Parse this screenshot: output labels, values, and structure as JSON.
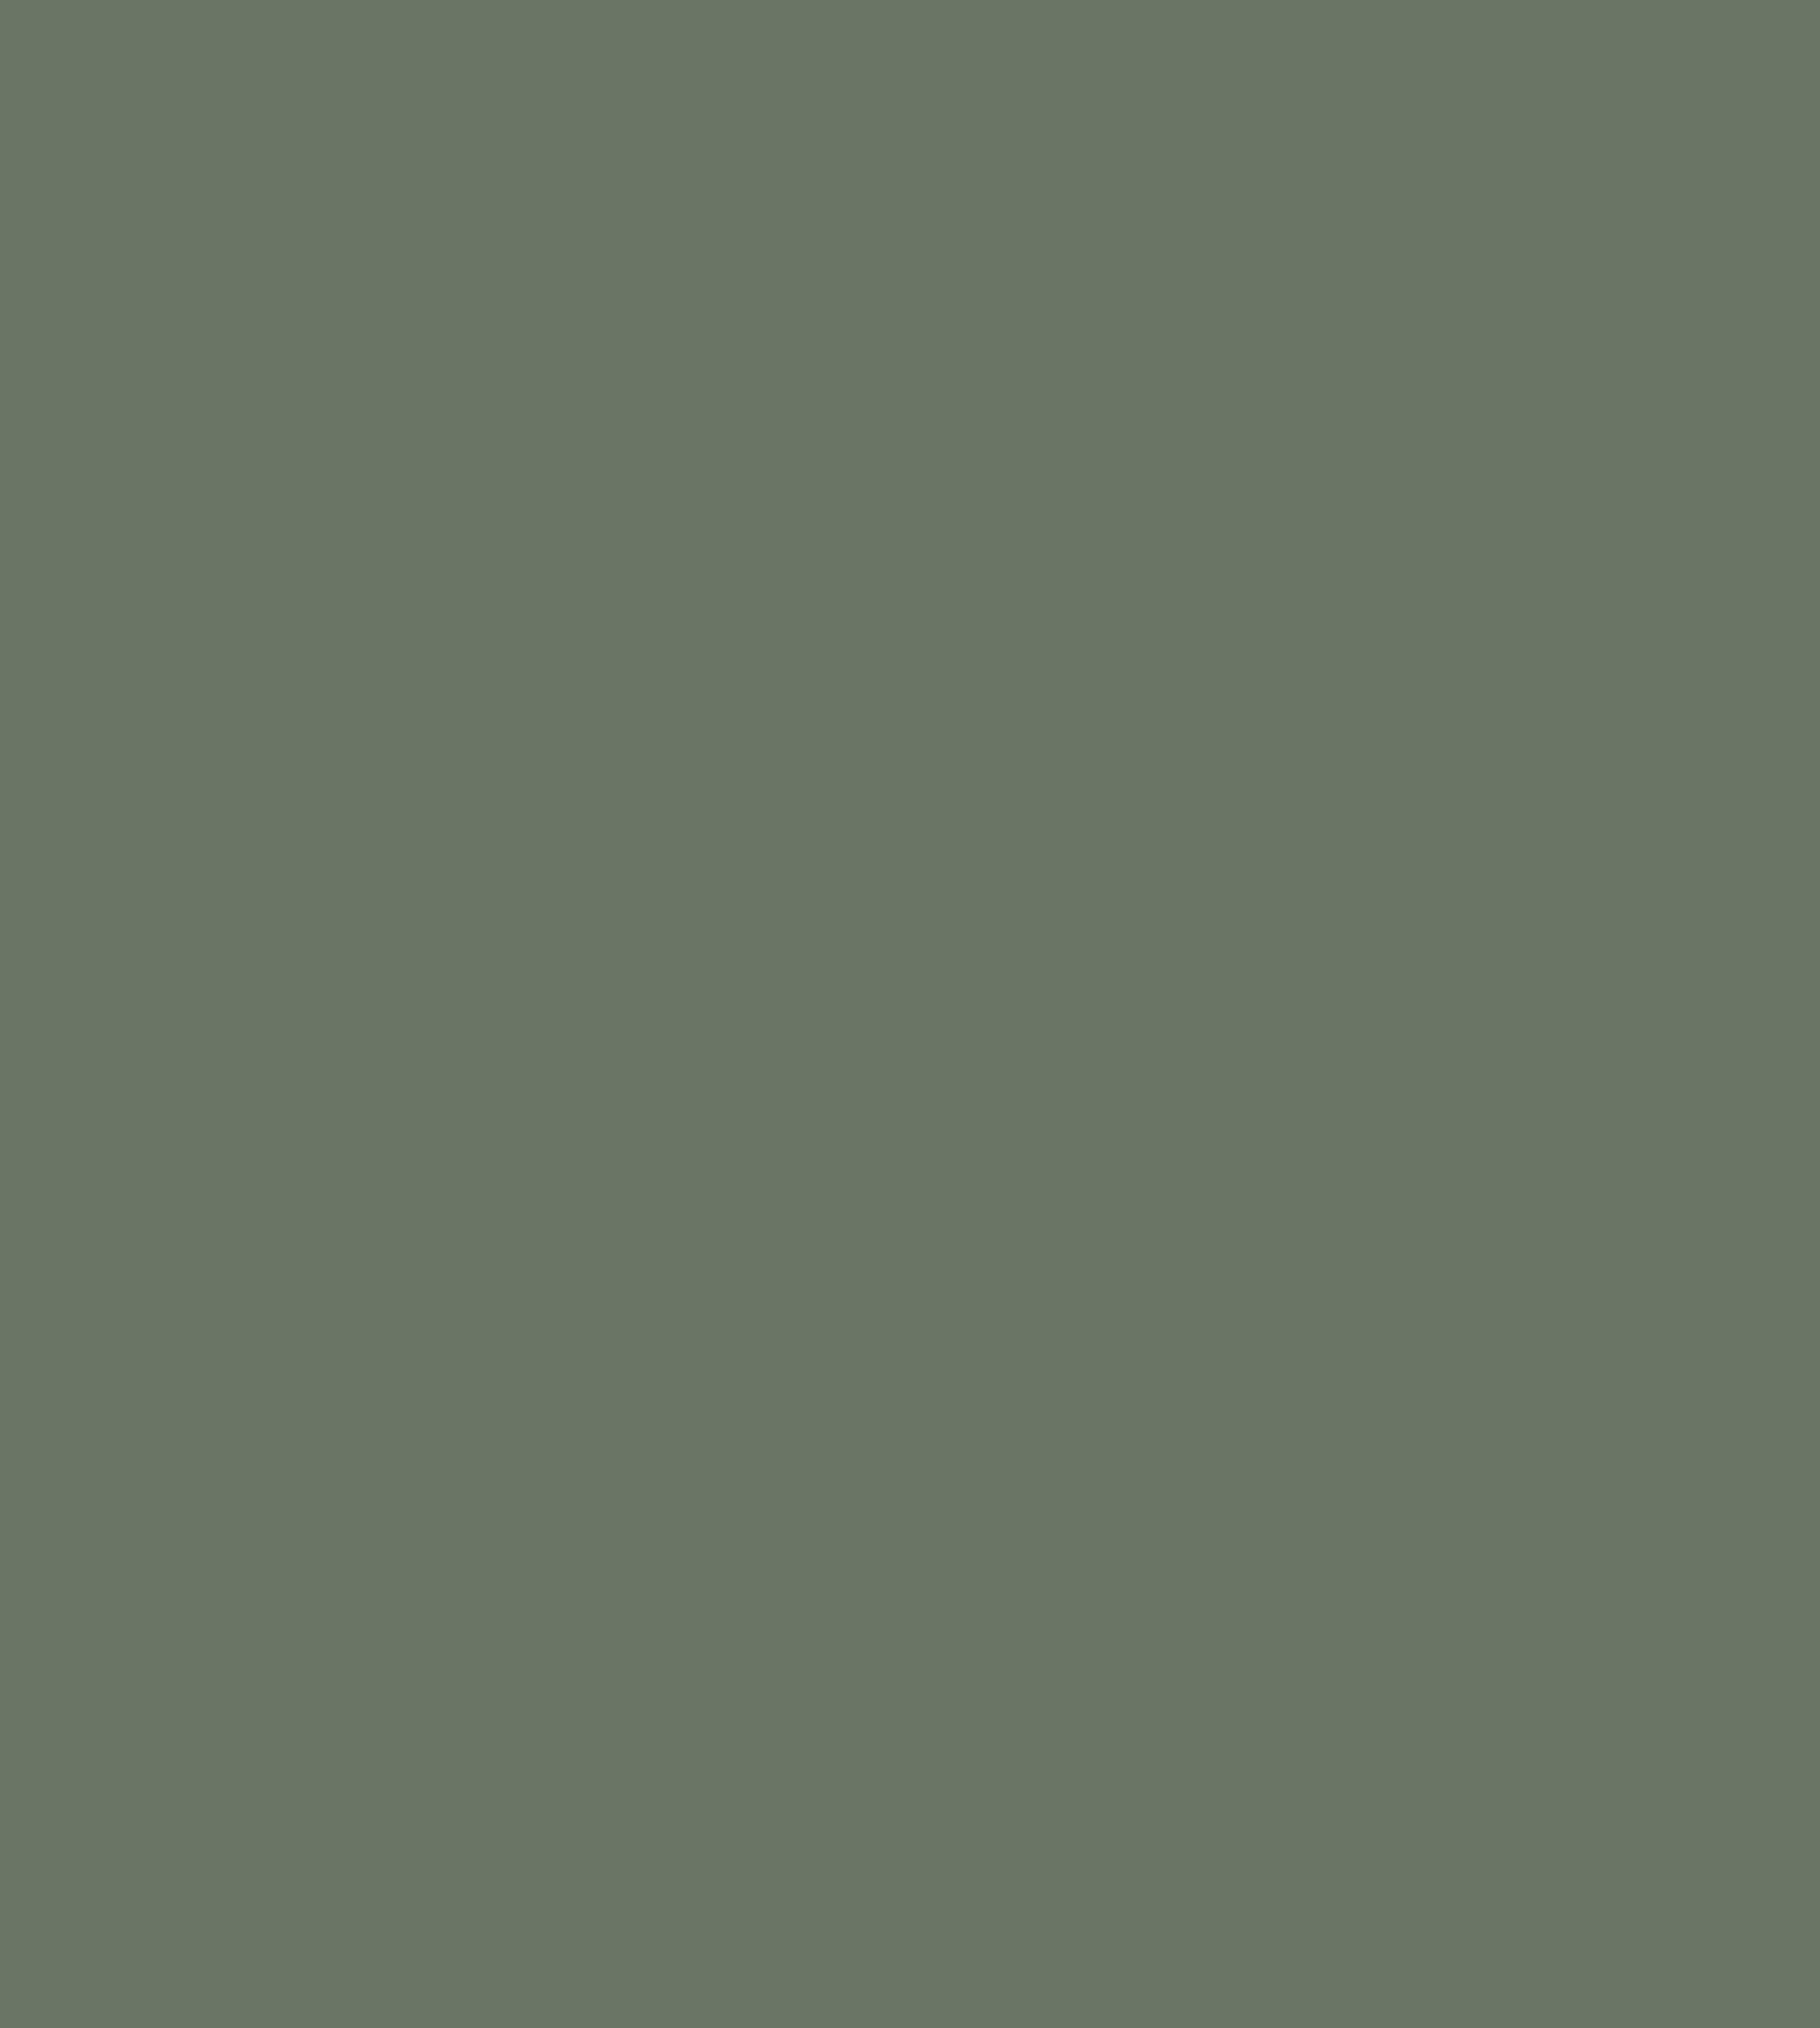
{
  "canvas": {
    "background_color": "#6A7566"
  }
}
